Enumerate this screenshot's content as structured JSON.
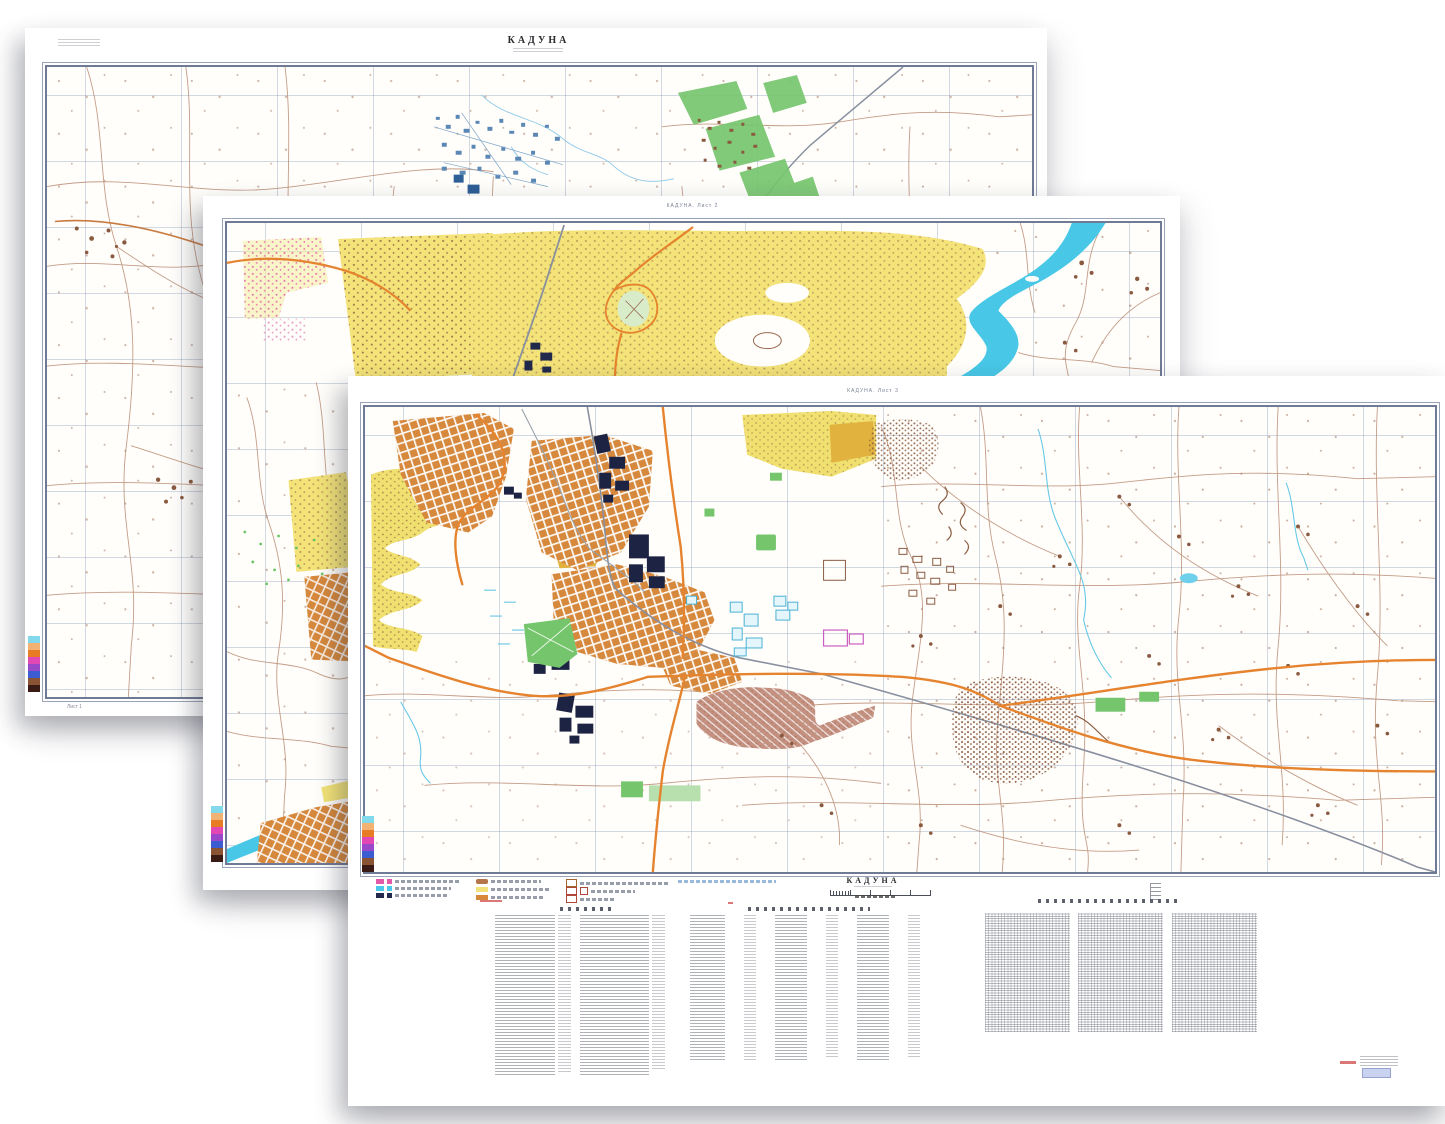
{
  "document": {
    "kind": "Soviet military city plan, three cascaded scanned sheets",
    "city_title": "КАДУНА"
  },
  "sheets": {
    "sheet1": {
      "title": "КАДУНА",
      "caption": "Лист 1"
    },
    "sheet2": {
      "header": "КАДУНА. Лист 2"
    },
    "sheet3": {
      "header": "КАДУНА. Лист 3",
      "footer_title": "КАДУНА"
    }
  },
  "color_bar": [
    "#83d9ec",
    "#f2b274",
    "#e87c24",
    "#e248b4",
    "#9a48ca",
    "#3c5cd2",
    "#8a5334",
    "#3a1a14"
  ],
  "legend": {
    "col1_swatches": [
      "#e45aa8",
      "#4cc8e8",
      "#232a4e"
    ],
    "col2_swatches": [
      "#b4764a",
      "#f2e279",
      "#d8883c"
    ],
    "outline_swatch_border": "#b04838",
    "faint_note_color": "#9ab8d8"
  },
  "map_colors": {
    "urban_yellow": "#f3e378",
    "urban_orange": "#d6883c",
    "important_building_navy": "#1d2342",
    "water_cyan": "#48c8e6",
    "greenery": "#74c56c",
    "contour_brown": "#b5846a",
    "highway_orange": "#e5832f",
    "railway_gray": "#8890a0",
    "grid_blue": "#8094b6",
    "frame_gray": "#6f7a96",
    "rose_builtup": "#c49080",
    "imprint_blue_box": "#c9d2ee"
  }
}
